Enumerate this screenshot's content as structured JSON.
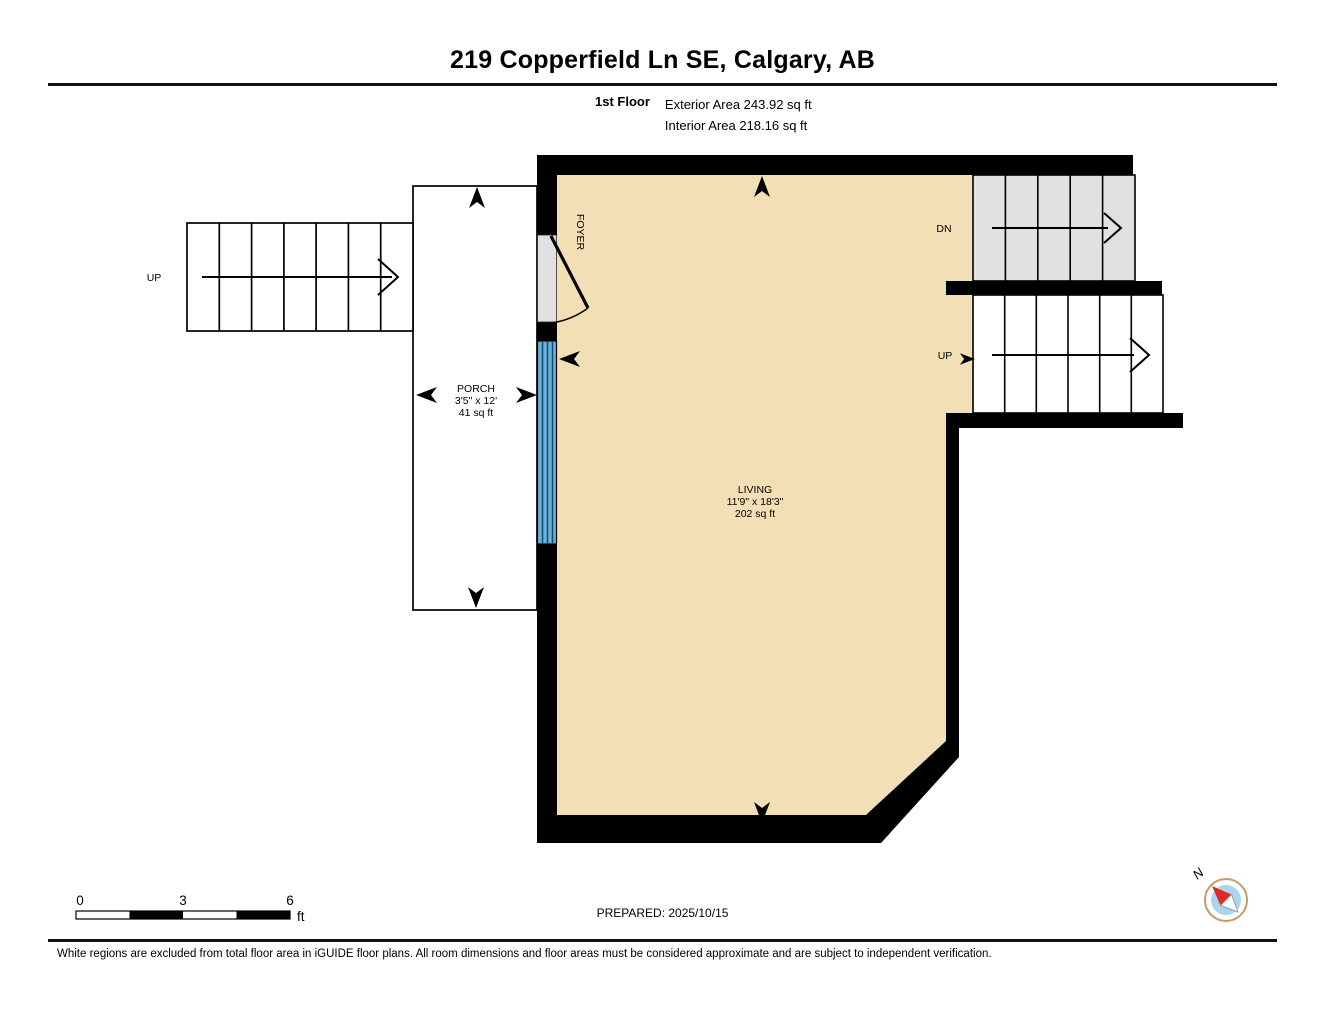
{
  "header": {
    "title": "219 Copperfield Ln SE, Calgary, AB",
    "floor_label": "1st Floor",
    "exterior_area": "Exterior Area 243.92 sq ft",
    "interior_area": "Interior Area 218.16 sq ft"
  },
  "plan": {
    "rooms": {
      "living": {
        "name": "LIVING",
        "dimensions": "11'9\" x 18'3\"",
        "area": "202 sq ft"
      },
      "porch": {
        "name": "PORCH",
        "dimensions": "3'5\" x 12'",
        "area": "41 sq ft"
      },
      "foyer": {
        "name": "FOYER"
      }
    },
    "stairs": {
      "exterior_up_label": "UP",
      "down_label": "DN",
      "interior_up_label": "UP"
    }
  },
  "scale_bar": {
    "start": "0",
    "middle": "3",
    "end": "6",
    "unit": "ft"
  },
  "footer": {
    "prepared": "PREPARED: 2025/10/15",
    "disclaimer": "White regions are excluded from total floor area in iGUIDE floor plans. All room dimensions and floor areas must be considered approximate and are subject to independent verification.",
    "compass_north": "N"
  },
  "colors": {
    "floor_fill": "#F2DFB6",
    "stair_fill": "#E1E1E1",
    "window_fill": "#68B1DC",
    "window_mullion": "#1B4A66",
    "door_fill": "#E0E0E3",
    "wall": "#000000",
    "compass_ring": "#C49C6B",
    "compass_inner": "#A8D5F1",
    "compass_needle": "#E02B20"
  }
}
